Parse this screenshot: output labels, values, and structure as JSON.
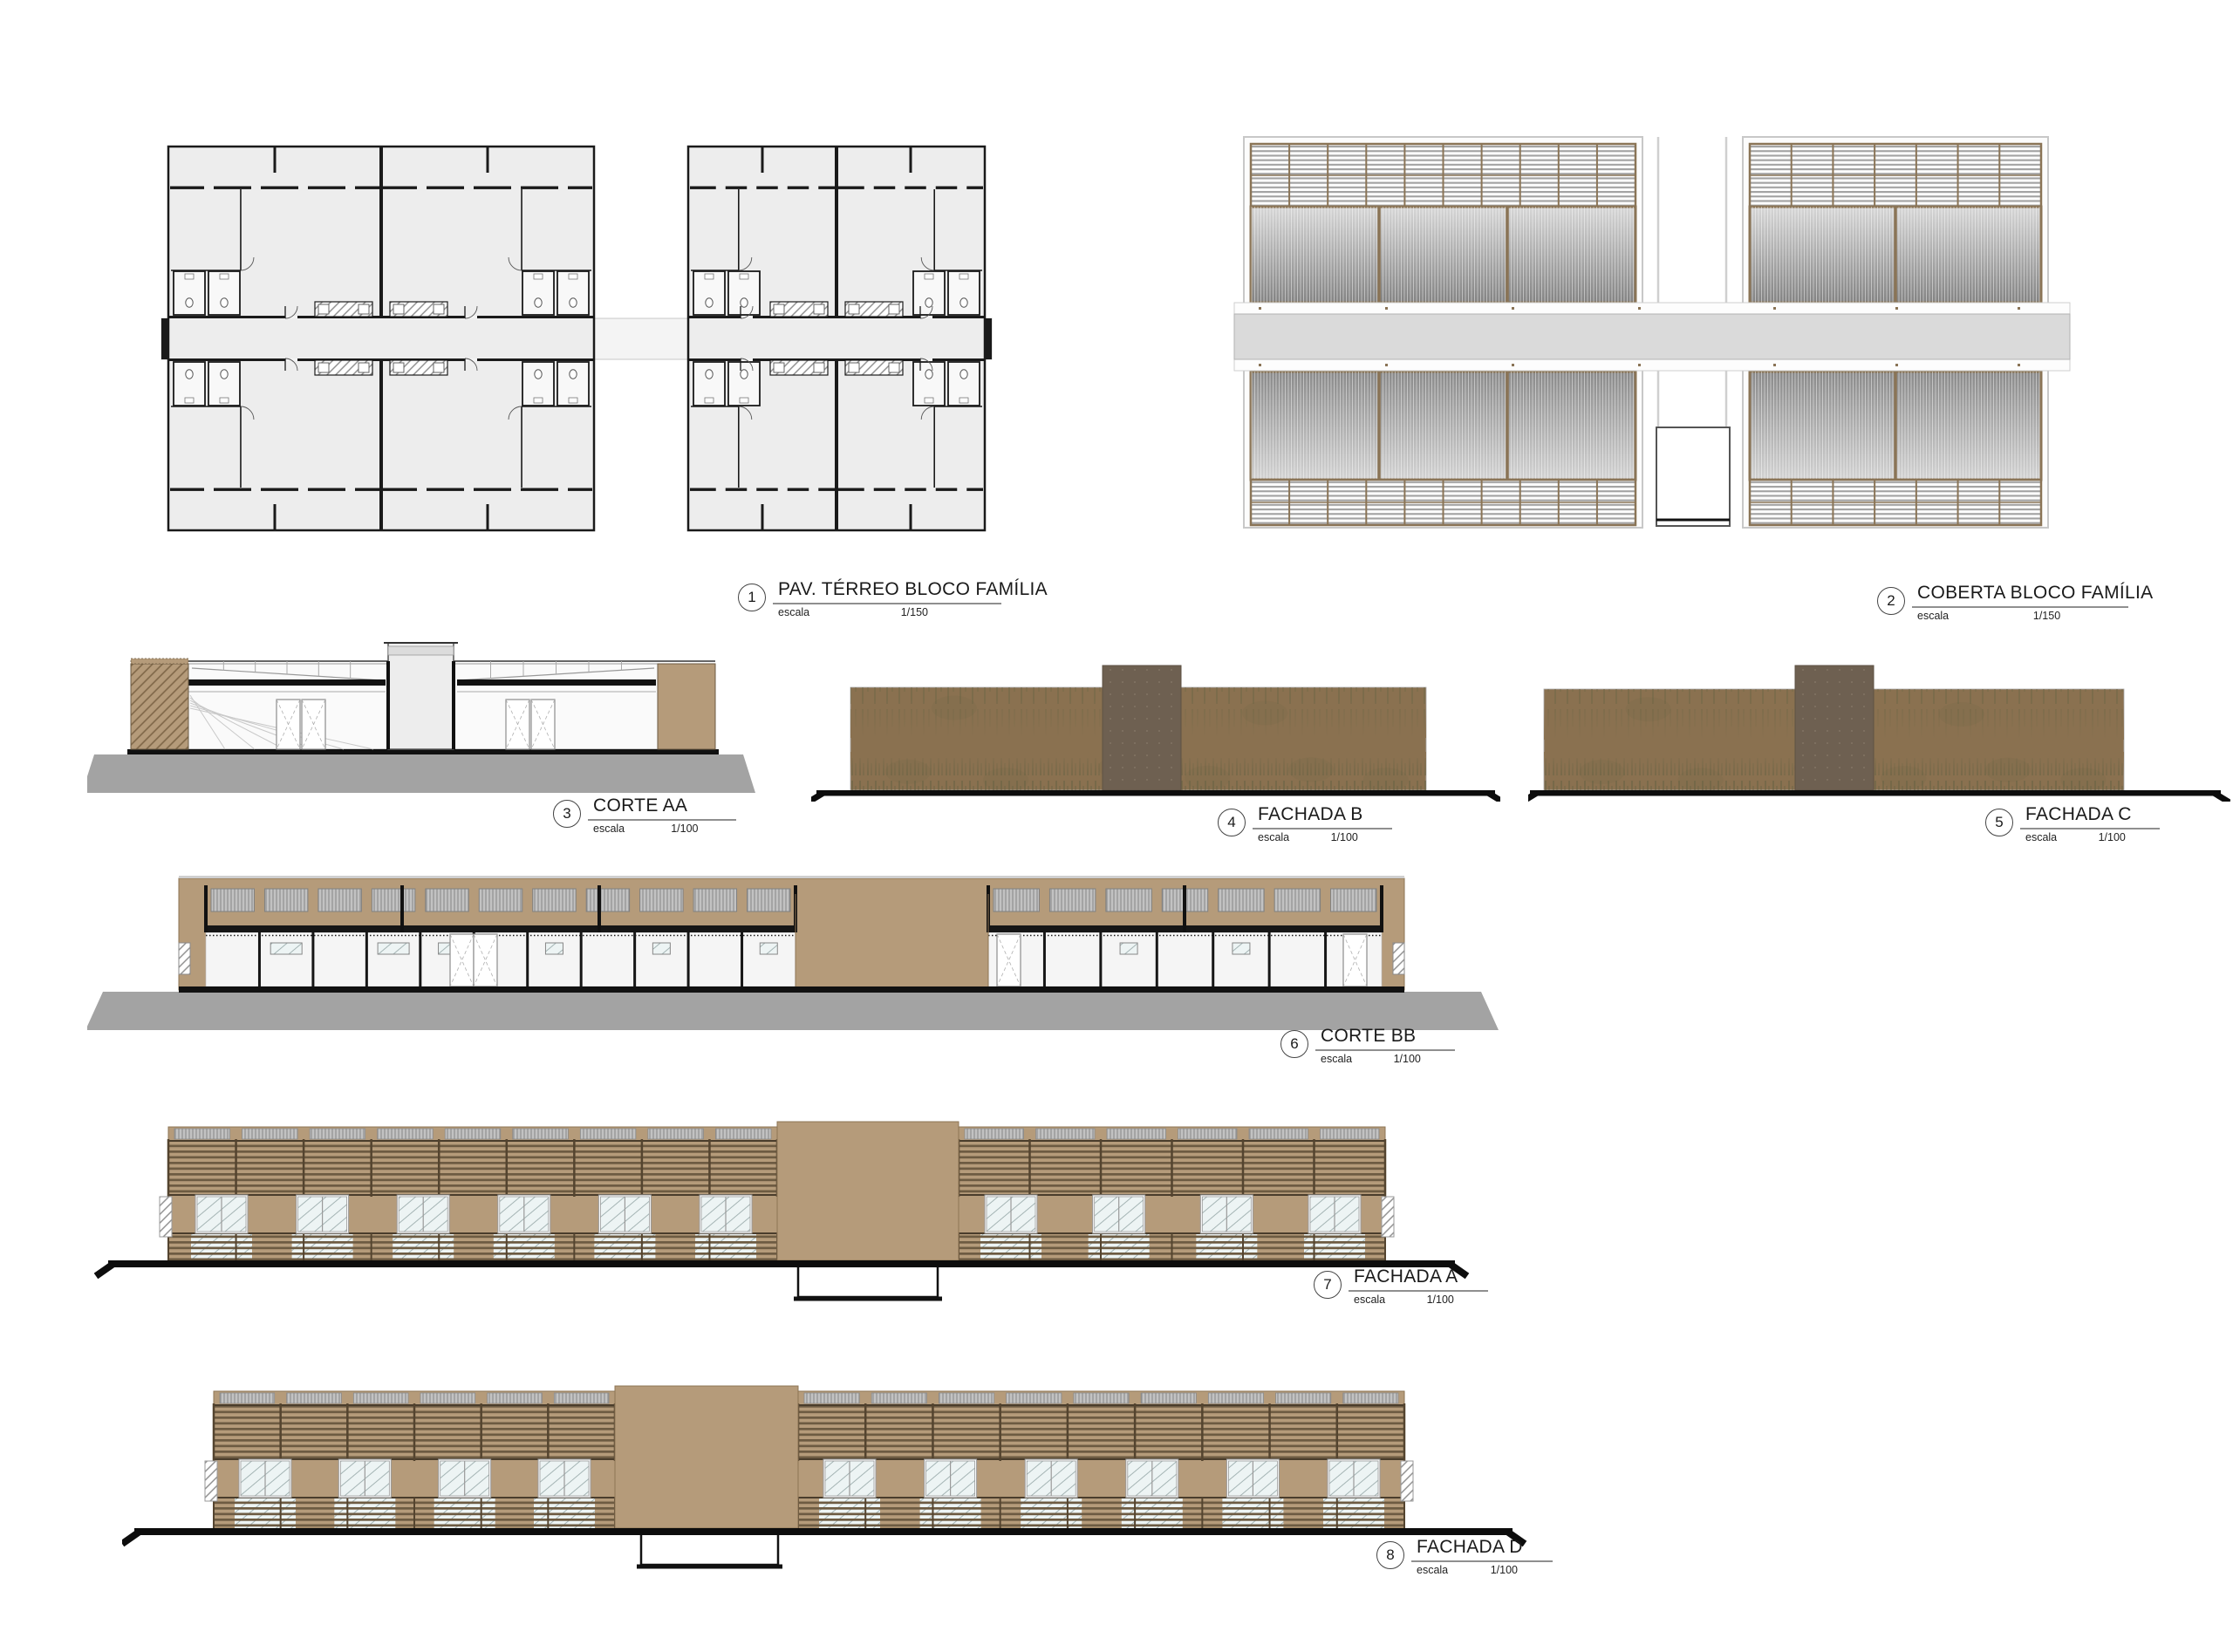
{
  "sheet": {
    "background": "#ffffff"
  },
  "palette": {
    "line": "#1a1a1a",
    "black": "#111111",
    "plan_fill": "#ededed",
    "plan_corridor": "#f4f4f4",
    "roof_frame_brown": "#8a7456",
    "corridor_slab": "#dadada",
    "tan_wall": "#b59b7a",
    "slat_dark": "#6d5b42",
    "veg_wall": "#8a7150",
    "veg_dark": "#6e6746",
    "tower_dark": "#6e6051",
    "ground_gray": "#a3a3a3",
    "glass": "#edf4f4",
    "metal_panel": "#c2c2c2"
  },
  "labels": [
    {
      "num": "1",
      "title": "PAV. TÉRREO  BLOCO FAMÍLIA",
      "escala": "escala",
      "scale": "1/150"
    },
    {
      "num": "2",
      "title": "COBERTA BLOCO FAMÍLIA",
      "escala": "escala",
      "scale": "1/150"
    },
    {
      "num": "3",
      "title": "CORTE AA",
      "escala": "escala",
      "scale": "1/100"
    },
    {
      "num": "4",
      "title": "FACHADA B",
      "escala": "escala",
      "scale": "1/100"
    },
    {
      "num": "5",
      "title": "FACHADA C",
      "escala": "escala",
      "scale": "1/100"
    },
    {
      "num": "6",
      "title": "CORTE BB",
      "escala": "escala",
      "scale": "1/100"
    },
    {
      "num": "7",
      "title": "FACHADA A",
      "escala": "escala",
      "scale": "1/100"
    },
    {
      "num": "8",
      "title": "FACHADA D",
      "escala": "escala",
      "scale": "1/100"
    }
  ],
  "geometry": {
    "roof": {
      "left_bays": 3,
      "right_bays": 2,
      "left_louver_cols": 10,
      "right_louver_cols": 7
    },
    "fachada_a": {
      "left_windows": 6,
      "right_windows": 4
    },
    "fachada_d": {
      "left_windows": 4,
      "right_windows": 6
    },
    "corte_bb": {
      "left_panels": 11,
      "right_panels": 7
    }
  }
}
